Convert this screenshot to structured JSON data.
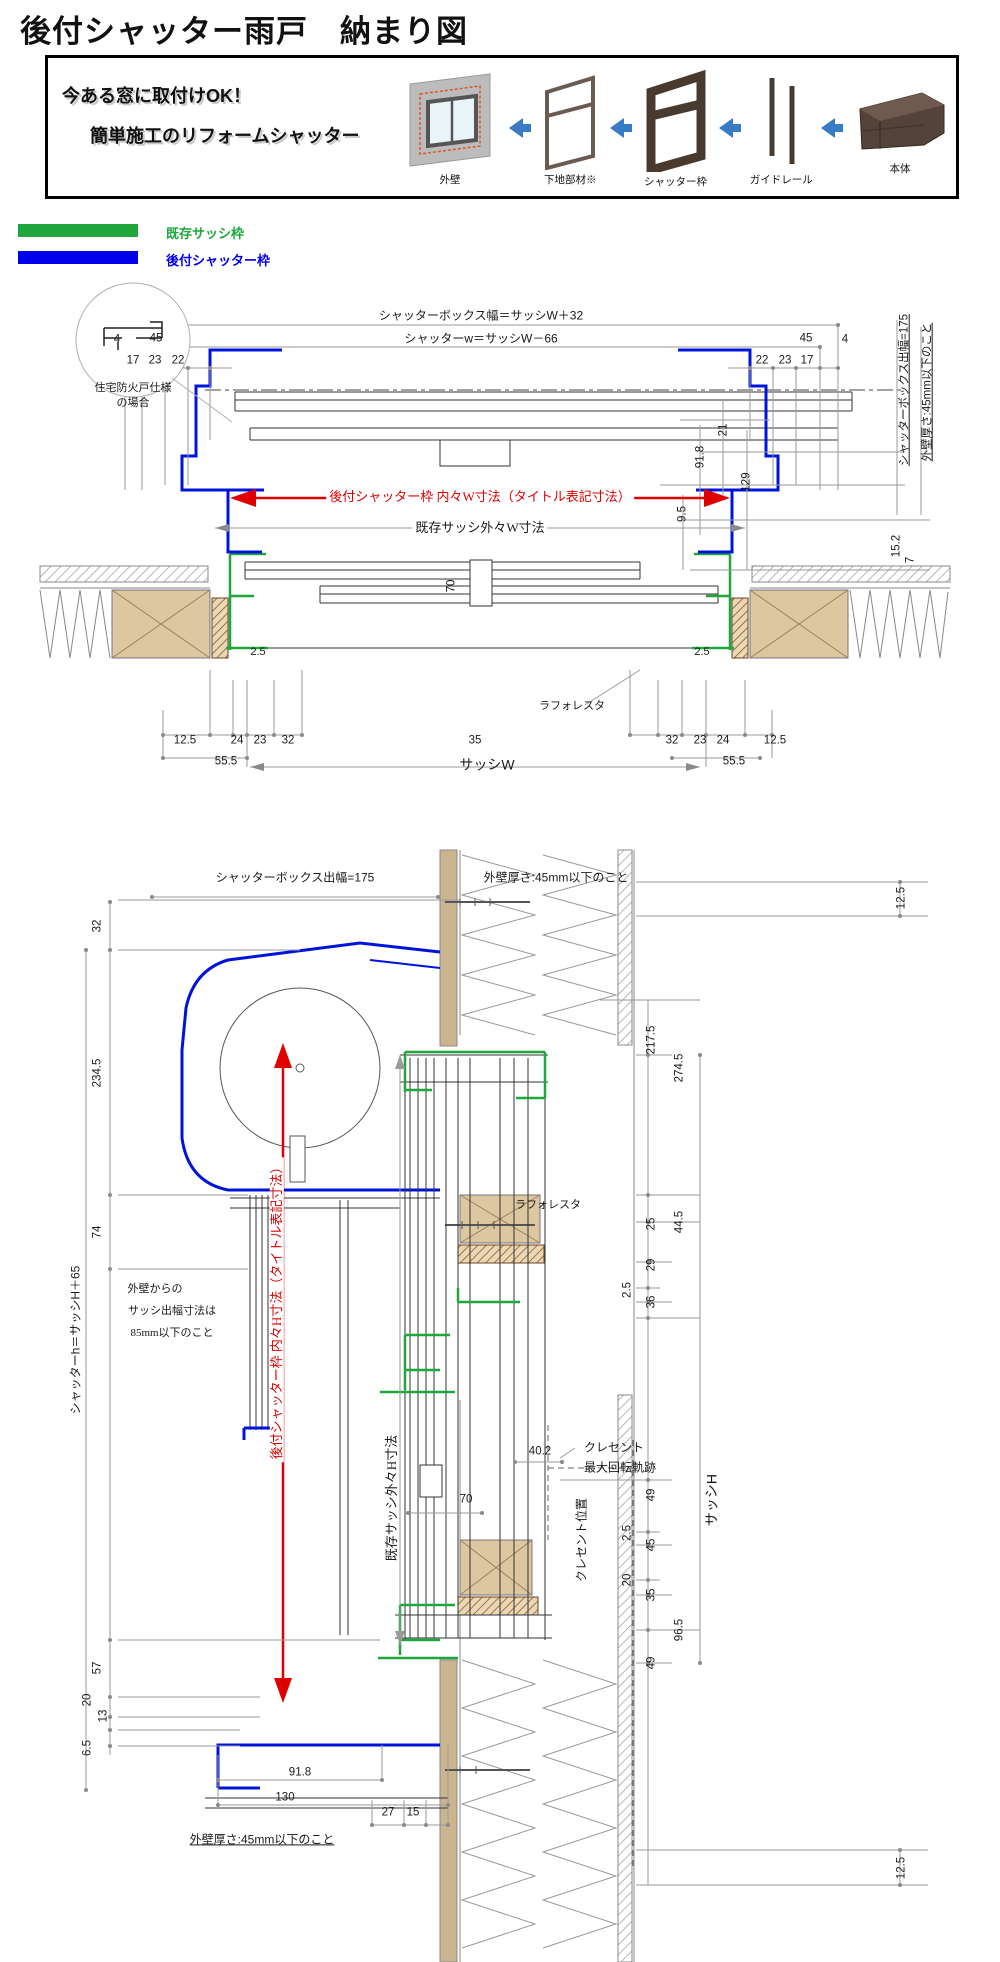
{
  "page": {
    "title": "後付シャッター雨戸　納まり図"
  },
  "promo": {
    "line1": "今ある窓に取付けOK！",
    "line2": "簡単施工のリフォームシャッター",
    "steps": [
      {
        "label": "外壁"
      },
      {
        "label": "下地部材※"
      },
      {
        "label": "シャッター枠"
      },
      {
        "label": "ガイドレール"
      },
      {
        "label": "本体"
      }
    ]
  },
  "legend": {
    "items": [
      {
        "label": "既存サッシ枠",
        "color": "#1fa73e"
      },
      {
        "label": "後付シャッター枠",
        "color": "#0000ea"
      }
    ]
  },
  "colors": {
    "existing_frame_green": "#1fa73e",
    "retrofit_frame_blue": "#0013d8",
    "dimension_red": "#dd0000",
    "dimension_gray": "#9a9a9a",
    "wood_tan": "#dcc7a1"
  },
  "drawing1": {
    "annotations": [
      {
        "t": "シャッターボックス幅＝サッシW＋32",
        "x": 481,
        "y": 316,
        "fs": 12
      },
      {
        "t": "シャッターw＝サッシW－66",
        "x": 481,
        "y": 339,
        "fs": 12
      },
      {
        "t": "4",
        "x": 117,
        "y": 340
      },
      {
        "t": "45",
        "x": 156,
        "y": 339
      },
      {
        "t": "45",
        "x": 806,
        "y": 339
      },
      {
        "t": "4",
        "x": 845,
        "y": 340
      },
      {
        "t": "17",
        "x": 133,
        "y": 361
      },
      {
        "t": "23",
        "x": 155,
        "y": 361
      },
      {
        "t": "22",
        "x": 178,
        "y": 361
      },
      {
        "t": "22",
        "x": 762,
        "y": 361
      },
      {
        "t": "23",
        "x": 785,
        "y": 361
      },
      {
        "t": "17",
        "x": 807,
        "y": 361
      },
      {
        "t": "住宅防火戸仕様",
        "x": 133,
        "y": 388,
        "fs": 11
      },
      {
        "t": "の場合",
        "x": 133,
        "y": 403,
        "fs": 11
      },
      {
        "t": "21",
        "x": 724,
        "y": 430,
        "r": 1
      },
      {
        "t": "91.8",
        "x": 701,
        "y": 457,
        "r": 1
      },
      {
        "t": "129",
        "x": 747,
        "y": 482,
        "r": 1
      },
      {
        "t": "9.5",
        "x": 683,
        "y": 514,
        "r": 1
      },
      {
        "t": "シャッターボックス出幅=175",
        "x": 905,
        "y": 390,
        "r": 1,
        "u": 1
      },
      {
        "t": "外壁厚さ:45mm以下のこと",
        "x": 928,
        "y": 392,
        "r": 1,
        "u": 1
      },
      {
        "t": "15.2",
        "x": 897,
        "y": 546,
        "r": 1
      },
      {
        "t": "7",
        "x": 911,
        "y": 560,
        "r": 1
      },
      {
        "t": "後付シャッター枠 内々W寸法（タイトル表記寸法）",
        "x": 480,
        "y": 497,
        "c": "red",
        "sf": 1,
        "fs": 13,
        "bg": 1
      },
      {
        "t": "既存サッシ外々W寸法",
        "x": 480,
        "y": 528,
        "sf": 1,
        "fs": 13,
        "bg": 1
      },
      {
        "t": "70",
        "x": 452,
        "y": 586,
        "r": 1
      },
      {
        "t": "2.5",
        "x": 258,
        "y": 652,
        "fs": 11
      },
      {
        "t": "2.5",
        "x": 702,
        "y": 652,
        "fs": 11
      },
      {
        "t": "ラフォレスタ",
        "x": 572,
        "y": 706,
        "fs": 11
      },
      {
        "t": "12.5",
        "x": 185,
        "y": 741
      },
      {
        "t": "24",
        "x": 237,
        "y": 741
      },
      {
        "t": "23",
        "x": 260,
        "y": 741
      },
      {
        "t": "32",
        "x": 288,
        "y": 741
      },
      {
        "t": "55.5",
        "x": 226,
        "y": 762
      },
      {
        "t": "35",
        "x": 475,
        "y": 741
      },
      {
        "t": "サッシW",
        "x": 487,
        "y": 765,
        "fs": 14
      },
      {
        "t": "32",
        "x": 672,
        "y": 741
      },
      {
        "t": "23",
        "x": 700,
        "y": 741
      },
      {
        "t": "24",
        "x": 723,
        "y": 741
      },
      {
        "t": "12.5",
        "x": 775,
        "y": 741
      },
      {
        "t": "55.5",
        "x": 734,
        "y": 762
      }
    ]
  },
  "drawing2": {
    "annotations": [
      {
        "t": "シャッターボックス出幅=175",
        "x": 295,
        "y": 878,
        "fs": 12
      },
      {
        "t": "外壁厚さ:45mm以下のこと",
        "x": 556,
        "y": 878,
        "fs": 12
      },
      {
        "t": "12.5",
        "x": 902,
        "y": 898,
        "r": 1
      },
      {
        "t": "32",
        "x": 98,
        "y": 926,
        "r": 1
      },
      {
        "t": "234.5",
        "x": 98,
        "y": 1073,
        "r": 1
      },
      {
        "t": "74",
        "x": 98,
        "y": 1232,
        "r": 1
      },
      {
        "t": "シャッターh＝サッシH＋65",
        "x": 76,
        "y": 1340,
        "r": 1,
        "fs": 12
      },
      {
        "t": "217.5",
        "x": 652,
        "y": 1040,
        "r": 1
      },
      {
        "t": "274.5",
        "x": 680,
        "y": 1068,
        "r": 1
      },
      {
        "t": "ラフォレスタ",
        "x": 548,
        "y": 1205,
        "fs": 11
      },
      {
        "t": "44.5",
        "x": 680,
        "y": 1222,
        "r": 1
      },
      {
        "t": "25",
        "x": 652,
        "y": 1224,
        "r": 1
      },
      {
        "t": "29",
        "x": 652,
        "y": 1265,
        "r": 1
      },
      {
        "t": "2.5",
        "x": 628,
        "y": 1290,
        "r": 1
      },
      {
        "t": "36",
        "x": 652,
        "y": 1302,
        "r": 1
      },
      {
        "t": "後付シャッター枠 内々H寸法（タイトル表記寸法）",
        "x": 277,
        "y": 1310,
        "r": 1,
        "c": "red",
        "sf": 1,
        "fs": 13,
        "bg": 1
      },
      {
        "t": "既存サッシ外々H寸法",
        "x": 392,
        "y": 1498,
        "r": 1,
        "sf": 1,
        "fs": 13,
        "bg": 1
      },
      {
        "t": "外壁からの",
        "x": 155,
        "y": 1289,
        "fs": 11,
        "sf": 1
      },
      {
        "t": "サッシ出幅寸法は",
        "x": 172,
        "y": 1311,
        "fs": 11,
        "sf": 1
      },
      {
        "t": "85mm以下のこと",
        "x": 172,
        "y": 1333,
        "fs": 11,
        "sf": 1
      },
      {
        "t": "40.2",
        "x": 540,
        "y": 1452
      },
      {
        "t": "クレセント",
        "x": 614,
        "y": 1448,
        "sf": 1,
        "fs": 12
      },
      {
        "t": "最大回転軌跡",
        "x": 620,
        "y": 1468,
        "sf": 1,
        "fs": 12
      },
      {
        "t": "クレセント位置",
        "x": 582,
        "y": 1540,
        "r": 1,
        "sf": 1,
        "fs": 12
      },
      {
        "t": "70",
        "x": 466,
        "y": 1500
      },
      {
        "t": "サッシH",
        "x": 712,
        "y": 1500,
        "r": 1,
        "fs": 14
      },
      {
        "t": "49",
        "x": 652,
        "y": 1495,
        "r": 1
      },
      {
        "t": "2.5",
        "x": 628,
        "y": 1533,
        "r": 1
      },
      {
        "t": "45",
        "x": 652,
        "y": 1545,
        "r": 1
      },
      {
        "t": "20",
        "x": 628,
        "y": 1580,
        "r": 1
      },
      {
        "t": "35",
        "x": 652,
        "y": 1595,
        "r": 1
      },
      {
        "t": "96.5",
        "x": 680,
        "y": 1630,
        "r": 1
      },
      {
        "t": "49",
        "x": 652,
        "y": 1663,
        "r": 1
      },
      {
        "t": "57",
        "x": 98,
        "y": 1668,
        "r": 1
      },
      {
        "t": "20",
        "x": 88,
        "y": 1700,
        "r": 1
      },
      {
        "t": "13",
        "x": 104,
        "y": 1716,
        "r": 1
      },
      {
        "t": "6.5",
        "x": 88,
        "y": 1748,
        "r": 1
      },
      {
        "t": "91.8",
        "x": 300,
        "y": 1773
      },
      {
        "t": "130",
        "x": 285,
        "y": 1798
      },
      {
        "t": "27",
        "x": 388,
        "y": 1813
      },
      {
        "t": "15",
        "x": 413,
        "y": 1813
      },
      {
        "t": "外壁厚さ:45mm以下のこと",
        "x": 262,
        "y": 1840,
        "u": 1,
        "fs": 12
      },
      {
        "t": "12.5",
        "x": 902,
        "y": 1868,
        "r": 1
      }
    ]
  }
}
